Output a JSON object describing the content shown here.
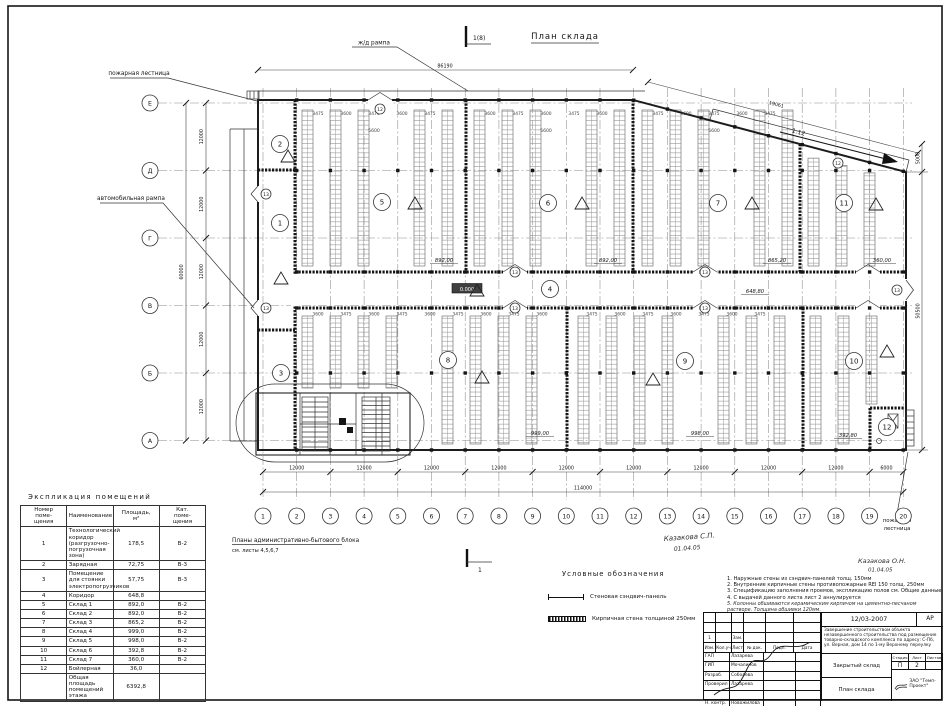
{
  "titles": {
    "plan_title": "План склада",
    "section_top": "1(8)",
    "section_bottom": "1"
  },
  "drawing": {
    "grid": {
      "cols": [
        "1",
        "2",
        "3",
        "4",
        "5",
        "6",
        "7",
        "8",
        "9",
        "10",
        "11",
        "12",
        "13",
        "14",
        "15",
        "16",
        "17",
        "18",
        "19",
        "20"
      ],
      "rows": [
        "Е",
        "Д",
        "Г",
        "В",
        "Б",
        "А"
      ]
    },
    "dims": {
      "bottom_segments": [
        "12000",
        "12000",
        "12000",
        "12000",
        "12000",
        "12000",
        "12000",
        "12000",
        "12000",
        "6000"
      ],
      "bottom_total": "114000",
      "left_segments": [
        "12000",
        "12000",
        "12000",
        "12000",
        "12000"
      ],
      "left_total": "60000",
      "top_total": "86190",
      "slope_length": "19061",
      "right_top": "5000",
      "right_side": "50500",
      "ramp_slope": "1:12",
      "level": "0.000",
      "rack_spacing": [
        "3475",
        "3600"
      ],
      "aisle": "5600"
    },
    "rooms": {
      "markers": [
        "1",
        "2",
        "3",
        "4",
        "5",
        "6",
        "7",
        "8",
        "9",
        "10",
        "11",
        "12"
      ],
      "area_labels": [
        "892,00",
        "892,00",
        "865,20",
        "360,00",
        "648,80",
        "999,00",
        "998,00",
        "392,80"
      ]
    },
    "door_marks": [
      "12",
      "13",
      "13",
      "13",
      "13",
      "13",
      "13",
      "13",
      "12"
    ],
    "labels": {
      "rail_ramp": "ж/д рампа",
      "fire_escape_top": "пожарная лестница",
      "auto_ramp": "автомобильная рампа",
      "fire_escape_bottom_1": "пожарная",
      "fire_escape_bottom_2": "лестница"
    },
    "admin_note": {
      "line1": "Планы административно-бытового блока",
      "line2": "см. листы 4,5,6,7"
    },
    "signatures": {
      "plan_name": "Казакова С.П.",
      "plan_date": "01.04.05",
      "notes_name": "Казакова О.Н.",
      "notes_date": "01.04.05"
    }
  },
  "explication": {
    "title": "Экспликация помещений",
    "headers": [
      "Номер\nпоме-\nщения",
      "Наименование",
      "Площадь,\nм²",
      "Кат.\nпоме-\nщения"
    ],
    "rows": [
      [
        "1",
        "Технологический коридор (разгруз­очно-погрузочная зона)",
        "178,5",
        "В-2"
      ],
      [
        "2",
        "Зарядная",
        "72,75",
        "В-3"
      ],
      [
        "3",
        "Помещение для стоянки электропогрузчиков",
        "57,75",
        "В-3"
      ],
      [
        "4",
        "Коридор",
        "648,8",
        ""
      ],
      [
        "5",
        "Склад 1",
        "892,0",
        "В-2"
      ],
      [
        "6",
        "Склад 2",
        "892,0",
        "В-2"
      ],
      [
        "7",
        "Склад 3",
        "865,2",
        "В-2"
      ],
      [
        "8",
        "Склад 4",
        "999,0",
        "В-2"
      ],
      [
        "9",
        "Склад 5",
        "998,0",
        "В-2"
      ],
      [
        "10",
        "Склад 6",
        "392,8",
        "В-2"
      ],
      [
        "11",
        "Склад 7",
        "360,0",
        "В-2"
      ],
      [
        "12",
        "Бойлерная",
        "36,0",
        ""
      ],
      [
        "",
        "Общая площадь помещений этажа",
        "6392,8",
        ""
      ]
    ]
  },
  "legend": {
    "title": "Условные обозначения",
    "items": [
      {
        "label": "Стеновая сэндвич-панель"
      },
      {
        "label": "Кирпичная стена толщиной 250мм"
      }
    ]
  },
  "notes": {
    "items": [
      "1.  Наружные стены из сэндвич-панелей толщ. 150мм",
      "2.  Внутренние кирпичные стены противопожарные REI 150 толщ. 250мм",
      "3.  Спецификацию заполнения проемов, экспликацию полов см. Общие данные",
      "4.  С выдачей данного листа лист 2 аннулируется"
    ],
    "hand_item": "5. Колонны обшиваются керамическим кирпичом на цементно-песчаном растворе. Толщина обшивки 120мм."
  },
  "titleblock": {
    "doc_number": "12/03-2007",
    "code": "АР",
    "description": "Завершение строительством объекта незавершенного строительства под размещение товарно-складского комплекса по адресу: С-Пб, ул. Верная, дом 14 по 1-му Верхнему переулку",
    "object_name": "Закрытый склад",
    "sheet_name": "План склада",
    "stage_label": "Стадия",
    "sheet_label": "Лист",
    "sheets_label": "Листов",
    "stage": "П",
    "sheet_no": "2",
    "company": "ЗАО \"Темп-Проект\"",
    "change_headers": [
      "Изм.",
      "Кол.уч",
      "Лист",
      "№ док.",
      "Подп.",
      "Дата"
    ],
    "change_row": [
      "1",
      "",
      "Зам.",
      "",
      "",
      ""
    ],
    "roles": [
      [
        "ГАП",
        "Лазарева"
      ],
      [
        "ГИП",
        "Мочалинов"
      ],
      [
        "Разраб.",
        "Соболева"
      ],
      [
        "Проверил",
        "Лазарева"
      ],
      [
        "",
        ""
      ],
      [
        "Н. контр.",
        "Новожилова"
      ]
    ]
  }
}
